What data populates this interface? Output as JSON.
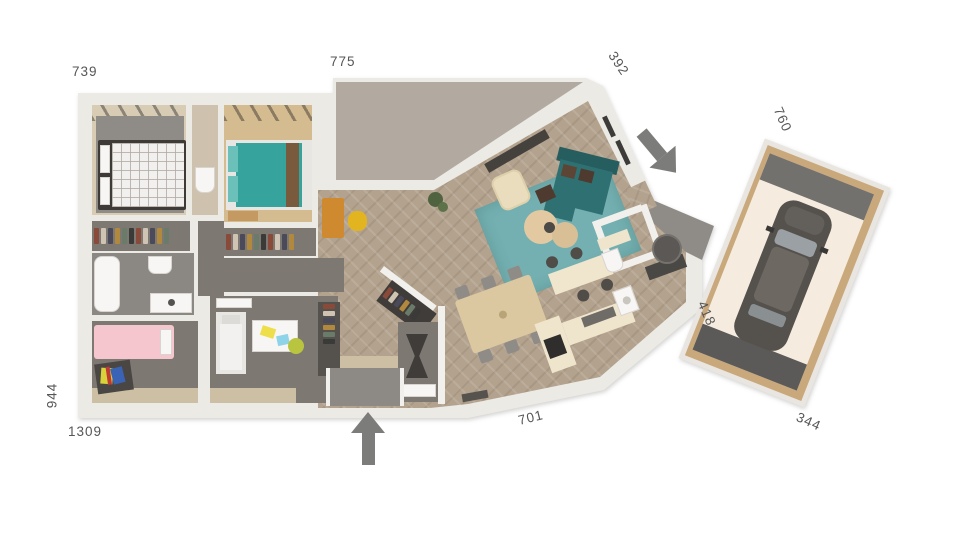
{
  "dimensions": {
    "top_left": "739",
    "top_middle": "775",
    "top_right_diagonal": "392",
    "garage_length": "760",
    "garage_width": "344",
    "house_right": "418",
    "bottom_middle": "701",
    "bottom_left": "1309",
    "left_side": "944"
  },
  "colors": {
    "wall": "#eceae5",
    "terrace_roof": "#b2aaa1",
    "wood_floor": "#b3a28d",
    "dark_floor": "#7d7872",
    "accent_teal_bed": "#37a39d",
    "sofa_teal": "#2f7173",
    "rug_teal": "#74b0b1",
    "kid_bed_pink": "#f5c6cd",
    "dining_wood": "#dcc8a0",
    "desk_orange": "#cf8a2f",
    "chair_yellow": "#e2b41f",
    "arrow_gray": "#7c7c7a",
    "garage_floor": "#f5ecdf",
    "car_body": "#55514d"
  },
  "markers": {
    "front_entrance": "arrow-up-icon",
    "side_entrance": "arrow-down-left-icon"
  }
}
